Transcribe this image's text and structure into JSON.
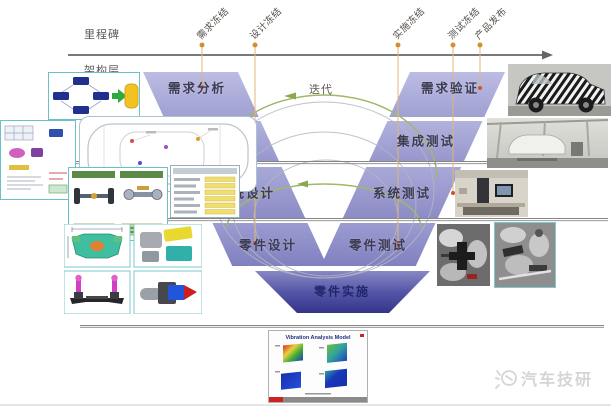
{
  "header": {
    "milestone_row_label": "里程碑",
    "architecture_row_label": "架构层"
  },
  "milestones": [
    {
      "label": "需求冻结"
    },
    {
      "label": "设计冻结"
    },
    {
      "label": "实施冻结"
    },
    {
      "label": "测试冻结"
    },
    {
      "label": "产品发布"
    }
  ],
  "vmodel": {
    "iteration_label": "迭代",
    "left_phases": [
      {
        "label": "需求分析"
      },
      {
        "label": "架构设计"
      },
      {
        "label": "系统设计"
      },
      {
        "label": "零件设计"
      }
    ],
    "right_phases": [
      {
        "label": "需求验证"
      },
      {
        "label": "集成测试"
      },
      {
        "label": "系统测试"
      },
      {
        "label": "零件测试"
      }
    ],
    "bottom_phase": {
      "label": "零件实施"
    }
  },
  "panels": {
    "vibration": {
      "title": "Vibration Analysis Model"
    }
  },
  "watermark": {
    "text": "汽车技研"
  },
  "colors": {
    "band_light": "#b6b6e0",
    "band_dark": "#3b3b8e",
    "milestone_dot": "#cf9030",
    "iteration_arc": "#9fb86a",
    "timeline": "#666666"
  }
}
